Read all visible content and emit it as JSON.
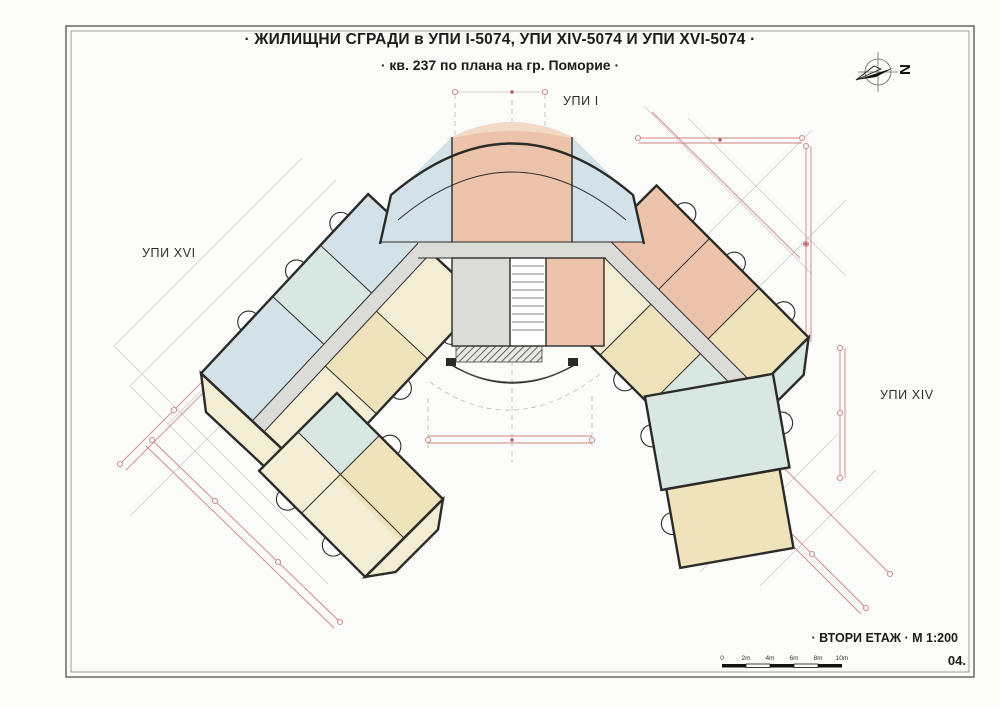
{
  "title": {
    "line1": "· ЖИЛИЩНИ СГРАДИ  в УПИ I-5074, УПИ XIV-5074 И УПИ XVI-5074 ·",
    "line2": "· кв. 237 по плана на  гр. Поморие ·"
  },
  "site_labels": {
    "top": "УПИ I",
    "left": "УПИ XVI",
    "right": "УПИ XIV"
  },
  "compass": {
    "letter": "N"
  },
  "footer": {
    "floor_label": "· ВТОРИ ЕТАЖ · М 1:200",
    "sheet_number": "04."
  },
  "scale_bar": {
    "labels": [
      "0",
      "2m",
      "4m",
      "6m",
      "8m",
      "10m"
    ]
  },
  "colors": {
    "wall": "#2b2b29",
    "room_teal": "#d8e7e1",
    "room_blue": "#d3e2e8",
    "room_peach": "#ecc3ab",
    "room_peach_light": "#f3d9c6",
    "room_cream": "#f3edd3",
    "room_yellow": "#efe3bb",
    "core_grey": "#dbdbd8",
    "dim_pink": "#cc8484",
    "dim_red": "#c05568",
    "axis_grey": "#c9c6c3",
    "frame": "#55524e"
  }
}
